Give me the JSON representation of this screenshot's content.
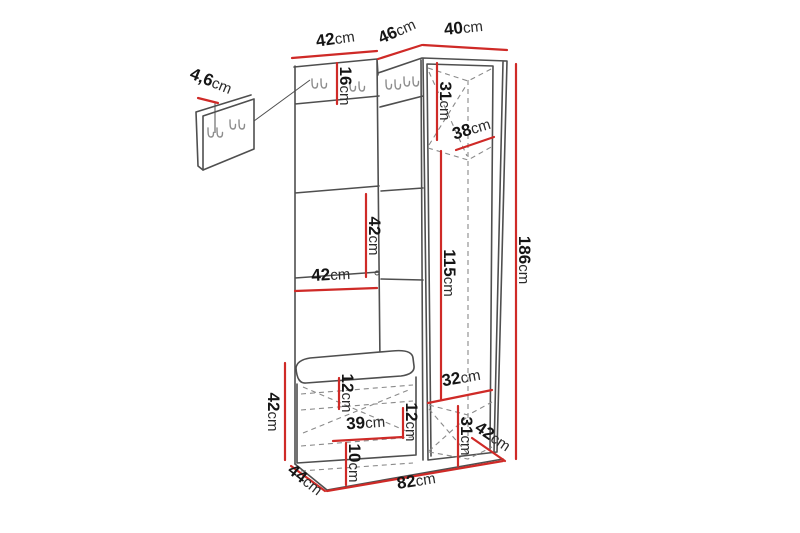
{
  "meta": {
    "title": "Hallway furniture set dimension diagram",
    "unit_system": "cm"
  },
  "colors": {
    "background": "#ffffff",
    "outline": "#4f4f4f",
    "dashed": "#8a8a8a",
    "dimension": "#cf2a27",
    "text": "#151515",
    "unit_text": "#2b2b2b"
  },
  "icons": {
    "coat_hook": "double-coat-hook-icon"
  },
  "dims": {
    "top_width_left": {
      "value": "42",
      "unit": "cm"
    },
    "top_width_middle": {
      "value": "46",
      "unit": "cm"
    },
    "top_width_right": {
      "value": "40",
      "unit": "cm"
    },
    "wall_panel_thickness": {
      "value": "4,6",
      "unit": "cm"
    },
    "hook_rail_height": {
      "value": "16",
      "unit": "cm"
    },
    "wardrobe_top_height": {
      "value": "31",
      "unit": "cm"
    },
    "wardrobe_diagonal": {
      "value": "38",
      "unit": "cm"
    },
    "shelf_gap_height": {
      "value": "42",
      "unit": "cm"
    },
    "shelf_width": {
      "value": "42",
      "unit": "cm"
    },
    "wardrobe_inner_height": {
      "value": "115",
      "unit": "cm"
    },
    "total_height": {
      "value": "186",
      "unit": "cm"
    },
    "wardrobe_inner_width": {
      "value": "32",
      "unit": "cm"
    },
    "bench_top_gap": {
      "value": "12",
      "unit": "cm"
    },
    "bench_inner_width": {
      "value": "39",
      "unit": "cm"
    },
    "bench_inner_gap": {
      "value": "12",
      "unit": "cm"
    },
    "bench_bottom_gap": {
      "value": "10",
      "unit": "cm"
    },
    "wardrobe_bottom_height": {
      "value": "31",
      "unit": "cm"
    },
    "wardrobe_depth": {
      "value": "42",
      "unit": "cm"
    },
    "bench_depth": {
      "value": "44",
      "unit": "cm"
    },
    "total_width": {
      "value": "82",
      "unit": "cm"
    },
    "bench_height": {
      "value": "42",
      "unit": "cm"
    }
  }
}
